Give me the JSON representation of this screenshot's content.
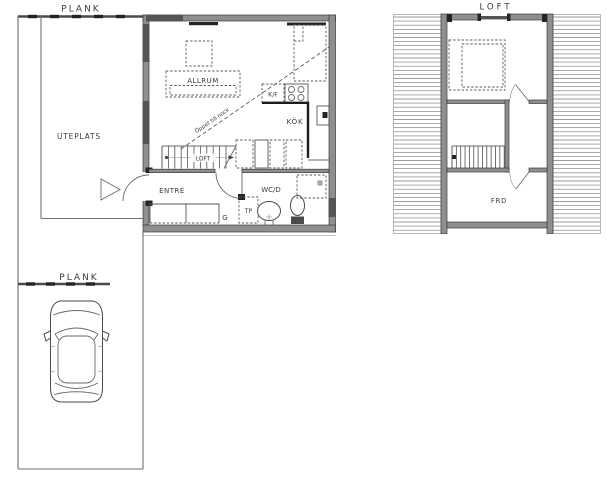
{
  "colors": {
    "background": "#ffffff",
    "line_gray": "#5f5f5f",
    "wall_gray": "#8f8f8f",
    "window_dark": "#555555",
    "accent_dark": "#222222"
  },
  "site": {
    "plank_top": "PLANK",
    "plank_bottom": "PLANK",
    "uteplats": "UTEPLATS"
  },
  "ground_floor": {
    "allrum": "ALLRUM",
    "open_to_ridge": "Öppet till nock",
    "kf": "K/F",
    "kok": "KÖK",
    "stairs_to": "LOFT",
    "entre": "ENTRÉ",
    "wcd": "WC/D",
    "tp": "TP",
    "g": "G"
  },
  "loft": {
    "title": "LOFT",
    "frd": "FRD"
  }
}
